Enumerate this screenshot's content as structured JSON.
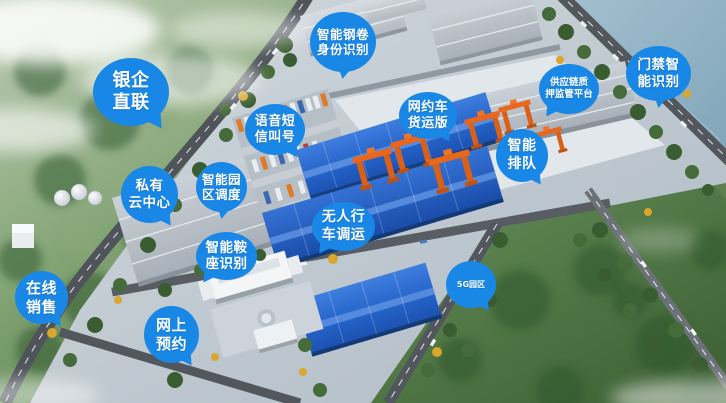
{
  "scene": {
    "bubble_color": "#1987e6",
    "bubble_text_color": "#ffffff"
  },
  "labels": [
    {
      "name": "bank-enterprise-direct-link",
      "lines": [
        "银企",
        "直联"
      ]
    },
    {
      "name": "smart-steel-coil-identity-recognition",
      "lines": [
        "智能钢卷",
        "身份识别"
      ]
    },
    {
      "name": "smart-door-access-recognition",
      "lines": [
        "门禁智",
        "能识别"
      ]
    },
    {
      "name": "supply-chain-pledge-supervision-platform",
      "lines": [
        "供应链质",
        "押监管平台"
      ]
    },
    {
      "name": "voice-sms-number-calling",
      "lines": [
        "语音短",
        "信叫号"
      ]
    },
    {
      "name": "ride-hailing-freight-edition",
      "lines": [
        "网约车",
        "货运版"
      ]
    },
    {
      "name": "smart-queueing",
      "lines": [
        "智能",
        "排队"
      ]
    },
    {
      "name": "private-cloud-center",
      "lines": [
        "私有",
        "云中心"
      ]
    },
    {
      "name": "smart-park-dispatching",
      "lines": [
        "智能园",
        "区调度"
      ]
    },
    {
      "name": "unmanned-overhead-crane-dispatch",
      "lines": [
        "无人行",
        "车调运"
      ]
    },
    {
      "name": "smart-saddle-recognition",
      "lines": [
        "智能鞍",
        "座识别"
      ]
    },
    {
      "name": "online-sales",
      "lines": [
        "在线",
        "销售"
      ]
    },
    {
      "name": "online-booking",
      "lines": [
        "网上",
        "预约"
      ]
    },
    {
      "name": "5g-park",
      "lines": [
        "5G园区"
      ]
    }
  ]
}
